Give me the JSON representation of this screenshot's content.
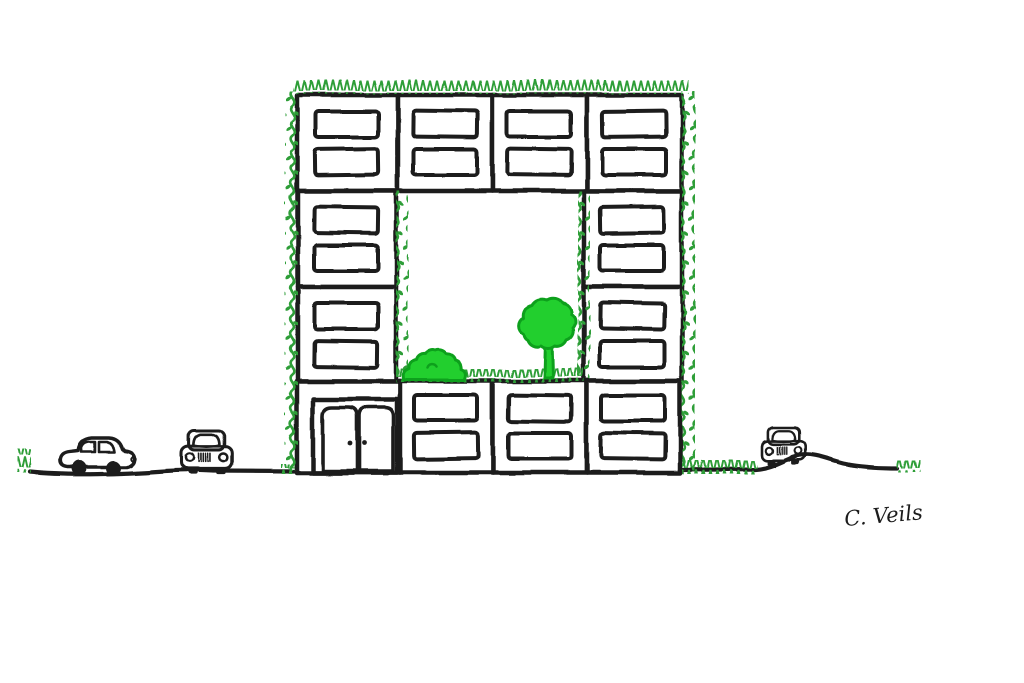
{
  "illustration": {
    "signature": "C. Veils",
    "colors": {
      "ink": "#1c1c1c",
      "vine": "#2f9e38",
      "foliage": "#22cf2f",
      "foliage-outline": "#0fa01d",
      "paper": "#ffffff"
    },
    "building": {
      "floors": 4,
      "blocks_top_row": 4,
      "blocks_bottom_row": 4,
      "blocks_per_side_middle_rows": 2,
      "windows_per_block": 2,
      "door_panels": 2,
      "ivy_edges": [
        "top",
        "outer-left",
        "outer-right",
        "courtyard-left",
        "courtyard-right"
      ]
    },
    "courtyard": {
      "trees": 1,
      "bushes": 1,
      "grass_strip": true
    },
    "street": {
      "cars_side_view": 1,
      "cars_front_view": 2,
      "grass_tufts": 4,
      "hill_under_right_car": true
    }
  }
}
